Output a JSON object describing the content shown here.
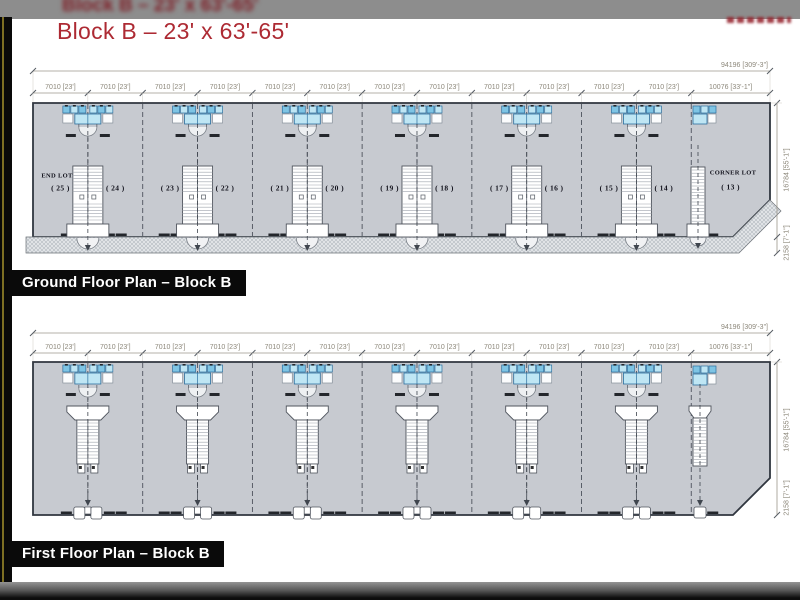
{
  "window": {
    "ghost_title": "Block B – 23' x 63'-65'",
    "title": "Block B – 23' x 63'-65'"
  },
  "colors": {
    "title_red": "#ad2a33",
    "plan_fill": "#c7cad0",
    "wall": "#30363f",
    "fixture_blue": "#bfe6f4",
    "fixture_blue_dark": "#7ec4e4",
    "fixture_stroke": "#2d6f9e",
    "walk_fill": "#e0e3e6",
    "dim_text": "#8d887b",
    "label_bg": "#0a0a0a",
    "label_text": "#ffffff",
    "top_band": "#8d8d8d",
    "accent_line": "#7d6f23"
  },
  "plans": [
    {
      "id": "ground",
      "label": "Ground Floor Plan – Block B",
      "dims": {
        "overall": "94196 [309'-3\"]",
        "segment": "7010 [23']",
        "segment_repeat": 12,
        "corner_segment": "10076 [33'-1\"]",
        "side_upper": "16784 [55'-1\"]",
        "side_lower": "2158 [7'-1\"]"
      },
      "annotations": {
        "end_lot": "END LOT",
        "corner_lot": "CORNER LOT"
      },
      "units": [
        "( 25 )",
        "( 24 )",
        "( 23 )",
        "( 22 )",
        "( 21 )",
        "( 20 )",
        "( 19 )",
        "( 18 )",
        "( 17 )",
        "( 16 )",
        "( 15 )",
        "( 14 )"
      ],
      "corner_unit": "( 13 )"
    },
    {
      "id": "first",
      "label": "First Floor Plan – Block B",
      "dims": {
        "overall": "94196 [309'-3\"]",
        "segment": "7010 [23']",
        "segment_repeat": 12,
        "corner_segment": "10076 [33'-1\"]",
        "side_upper": "16784 [55'-1\"]",
        "side_lower": "2158 [7'-1\"]"
      },
      "units": [],
      "corner_unit": ""
    }
  ]
}
